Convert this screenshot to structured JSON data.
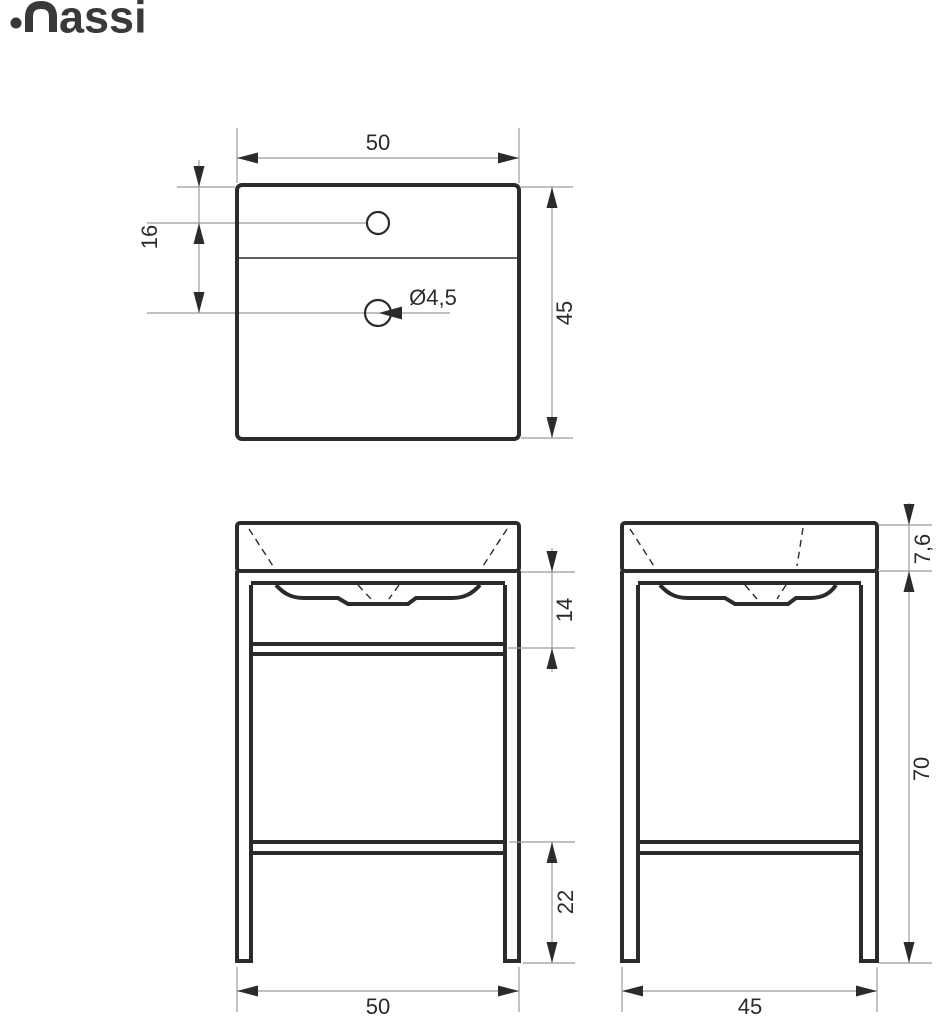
{
  "brand": {
    "name": "massi",
    "wordmark_tail": "assi"
  },
  "dimensions": {
    "top_width": "50",
    "top_depth": "45",
    "hole_spacing": "16",
    "hole_diameter": "Ø4,5",
    "basin_to_bar": "14",
    "basin_height": "7,6",
    "stand_height": "70",
    "shelf_to_floor": "22",
    "front_width": "50",
    "side_depth": "45"
  },
  "colors": {
    "line": "#2b2b2b",
    "dim_line": "#9b9b9b",
    "logo": "#39393b",
    "background": "#ffffff"
  }
}
